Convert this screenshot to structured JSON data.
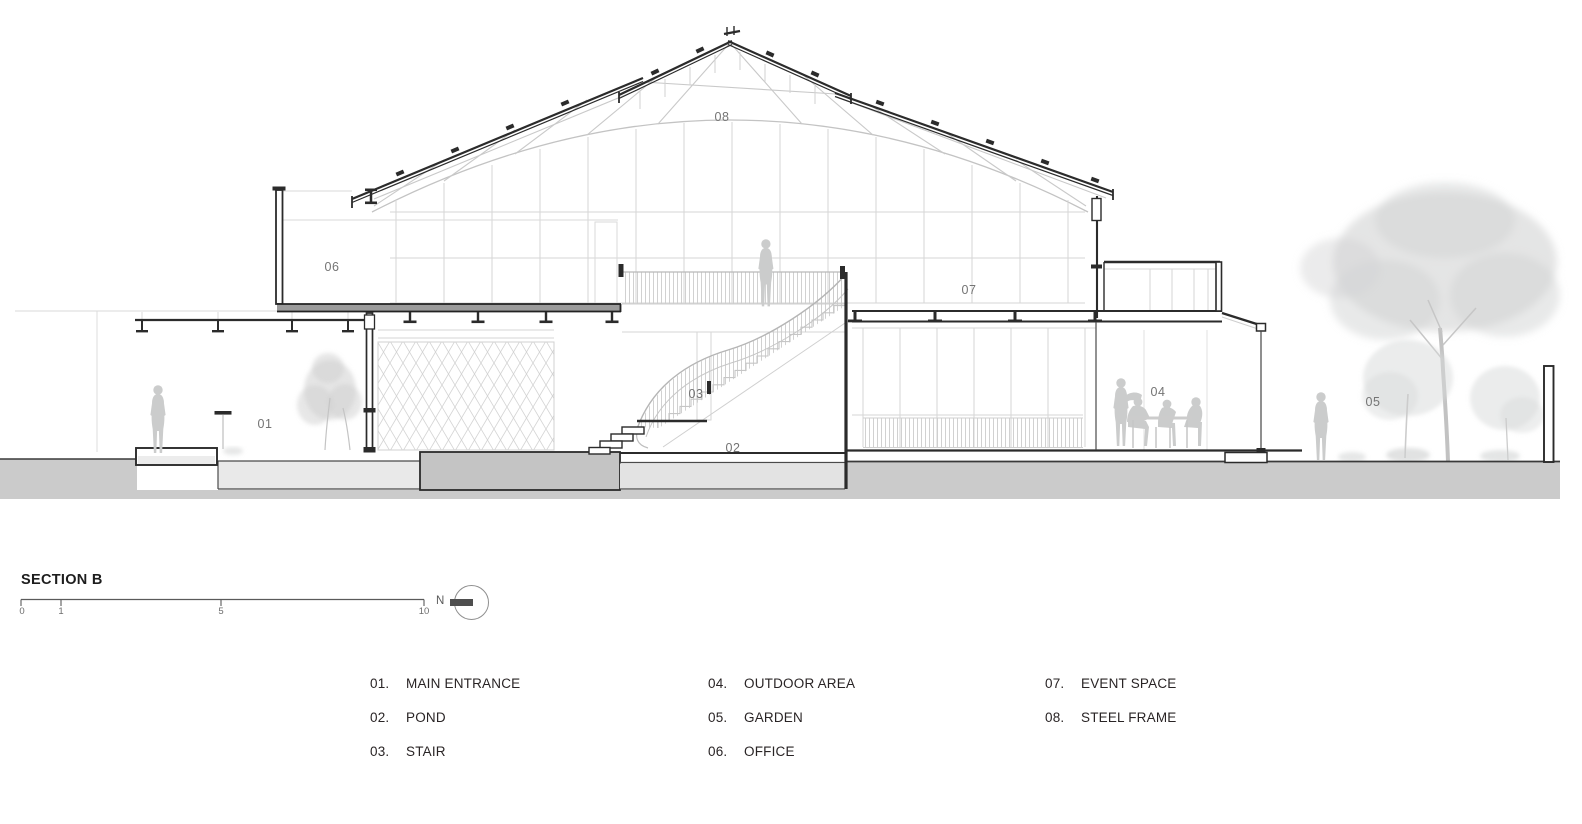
{
  "sheet": {
    "title": "SECTION B",
    "north_label": "N",
    "scale_ticks": {
      "t0": "0",
      "t1": "1",
      "t2": "5",
      "t3": "10"
    }
  },
  "annotations": {
    "a01": "01",
    "a02": "02",
    "a03": "03",
    "a04": "04",
    "a05": "05",
    "a06": "06",
    "a07": "07",
    "a08": "08"
  },
  "legend": {
    "col1": [
      {
        "num": "01.",
        "label": "MAIN ENTRANCE"
      },
      {
        "num": "02.",
        "label": "POND"
      },
      {
        "num": "03.",
        "label": "STAIR"
      }
    ],
    "col2": [
      {
        "num": "04.",
        "label": "OUTDOOR AREA"
      },
      {
        "num": "05.",
        "label": "GARDEN"
      },
      {
        "num": "06.",
        "label": "OFFICE"
      }
    ],
    "col3": [
      {
        "num": "07.",
        "label": "EVENT SPACE"
      },
      {
        "num": "08.",
        "label": "STEEL FRAME"
      }
    ]
  },
  "colors": {
    "line_dark": "#2b2b2b",
    "line_light": "#cdcdcd",
    "ground": "#cbcbcb",
    "ground_light": "#e9e9e9",
    "plinth_block": "#c4c4c4",
    "pond_water": "#e3e3e3",
    "slab": "#9b9b9b",
    "label_gray": "#747474",
    "figure_gray": "#cbcccc"
  }
}
